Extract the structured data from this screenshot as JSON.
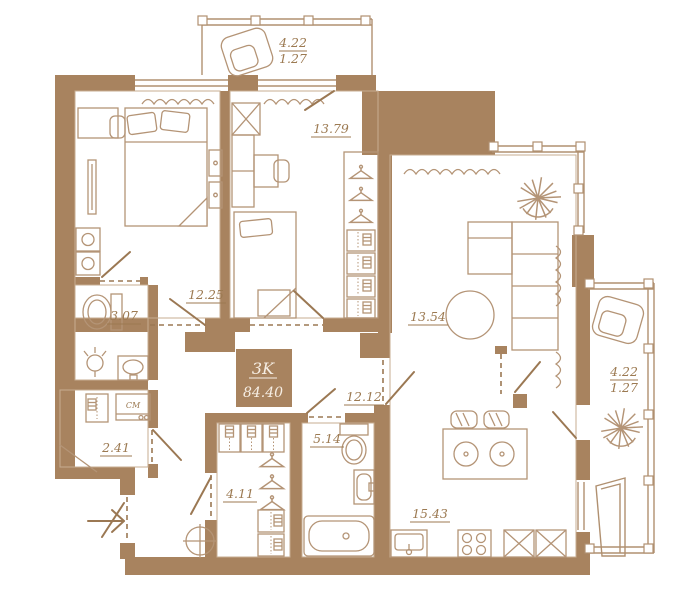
{
  "plan": {
    "type_label": "3K",
    "total_area": "84.40",
    "rooms": {
      "balcony_top": {
        "area": "4.22",
        "area_reduced": "1.27"
      },
      "bedroom1": {
        "area": "12.25"
      },
      "bedroom2": {
        "area": "13.79"
      },
      "living": {
        "area": "13.54"
      },
      "bathroom_small": {
        "area": "3.07"
      },
      "laundry": {
        "area": "2.41"
      },
      "hallway": {
        "area": "12.12"
      },
      "wardrobe": {
        "area": "4.11"
      },
      "bathroom": {
        "area": "5.14"
      },
      "kitchen": {
        "area": "15.43"
      },
      "balcony_right": {
        "area": "4.22",
        "area_reduced": "1.27"
      }
    },
    "appliance_labels": {
      "washing_machine": "СМ"
    },
    "icons": [
      "armchair-icon",
      "plant-icon",
      "double-bed-icon",
      "single-bed-icon",
      "desk-icon",
      "wardrobe-icon",
      "hanger-icon",
      "toilet-icon",
      "washbasin-icon",
      "bathtub-icon",
      "lamp-icon",
      "dining-table-icon",
      "stove-icon",
      "kitchen-sink-icon",
      "ceiling-light-icon",
      "entry-arrow-icon",
      "washing-machine-icon"
    ],
    "colors": {
      "wall": "#a8835f",
      "furniture_line": "#b49476",
      "glazing_line": "#b09070",
      "door_line": "#9b7853",
      "label_text": "#9c7a52",
      "info_box_text": "#f6eee4",
      "background": "#ffffff"
    }
  }
}
